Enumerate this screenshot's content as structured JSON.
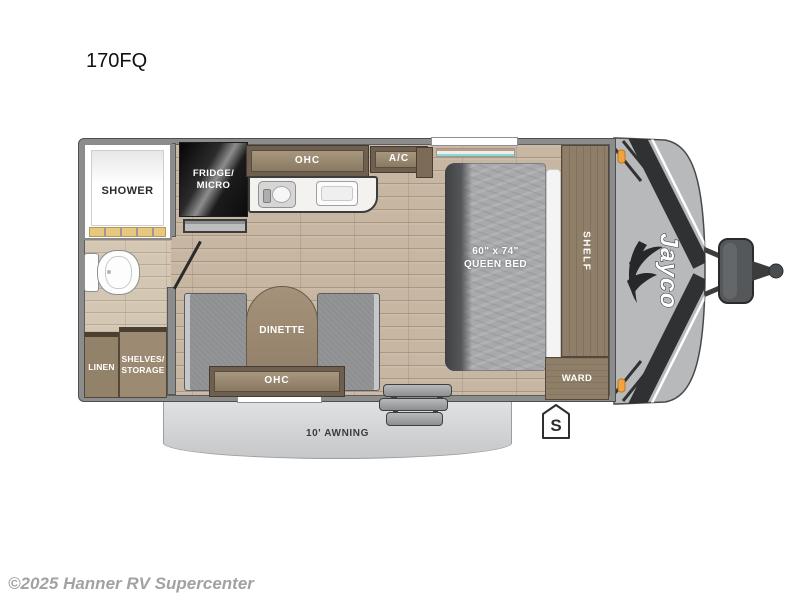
{
  "page": {
    "title": "170FQ",
    "copyright": "©2025 Hanner RV Supercenter"
  },
  "brand": {
    "logo_text": "Jayco"
  },
  "floorplan": {
    "labels": {
      "shower": "SHOWER",
      "fridge_micro": "FRIDGE/\nMICRO",
      "kitchen_ohc": "OHC",
      "ac": "A/C",
      "bed": "60\" x 74\"\nQUEEN BED",
      "shelf": "SHELF",
      "ward": "WARD",
      "dinette": "DINETTE",
      "dinette_ohc": "OHC",
      "linen": "LINEN",
      "shelves_storage": "SHELVES/\nSTORAGE",
      "awning": "10' AWNING",
      "spare_marker": "S"
    },
    "colors": {
      "wall": "#8b8c8c",
      "floor_wood": "#c7b6a1",
      "bath_floor": "#d3c6b2",
      "cabinet_wood": "#8f7e68",
      "front_cap": "#b7b9bb",
      "graphic_dark": "#2f3133",
      "marker_light_orange": "#f2a33c",
      "mattress_gray": "#a7a9ab"
    }
  }
}
